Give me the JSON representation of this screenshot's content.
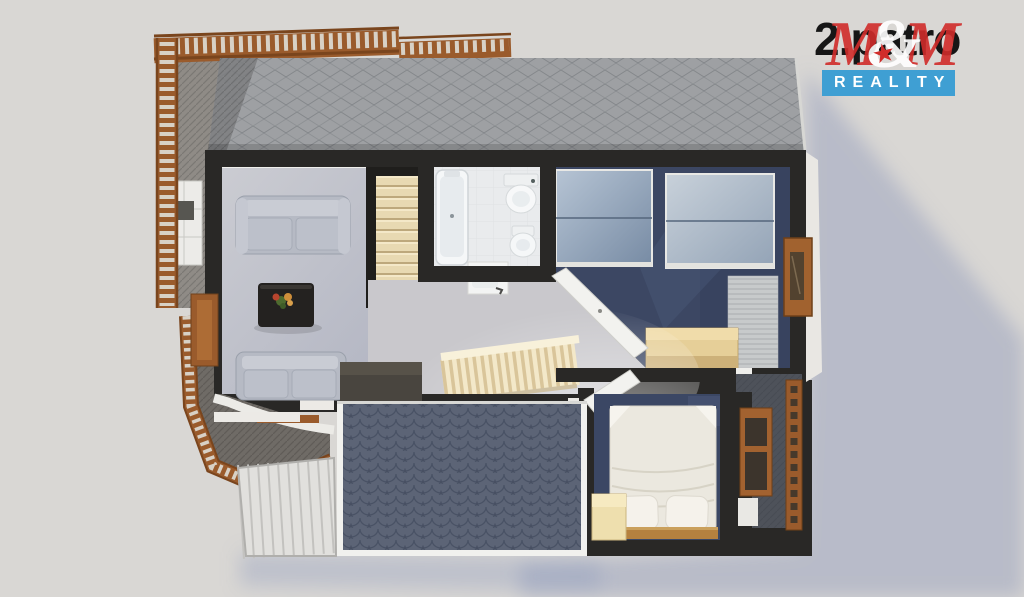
{
  "logo": {
    "watermark_text": "2.patro",
    "brand_m_left": "M",
    "brand_ampersand": "&",
    "brand_star_glyph": "★",
    "brand_m_right": "M",
    "banner_text": "REALITY"
  },
  "palette": {
    "background": "#d9d7d4",
    "shadow_blue": "#97a0bd",
    "roof_top_gray": "#9ea0a3",
    "roof_bottom_blue": "#5c6476",
    "wall_black": "#292826",
    "wood_brown": "#9a5b2c",
    "wood_light": "#e6cf98",
    "floor_living_gray": "#bfc1ca",
    "floor_bathroom_white": "#e9ebed",
    "floor_bedroom_navy": "#3c4763",
    "floor_landing_gray": "#c9c8cc",
    "stairs_beige": "#e8d9b2",
    "skylight_glass_blue": "#9db0c2",
    "bed_linen_white": "#ebe8df",
    "sofa_gray": "#b6bac4",
    "brand_red": "#d02c2a",
    "banner_blue": "#3f9fd3",
    "banner_text_white": "#ffffff",
    "watermark_black": "#161616"
  }
}
